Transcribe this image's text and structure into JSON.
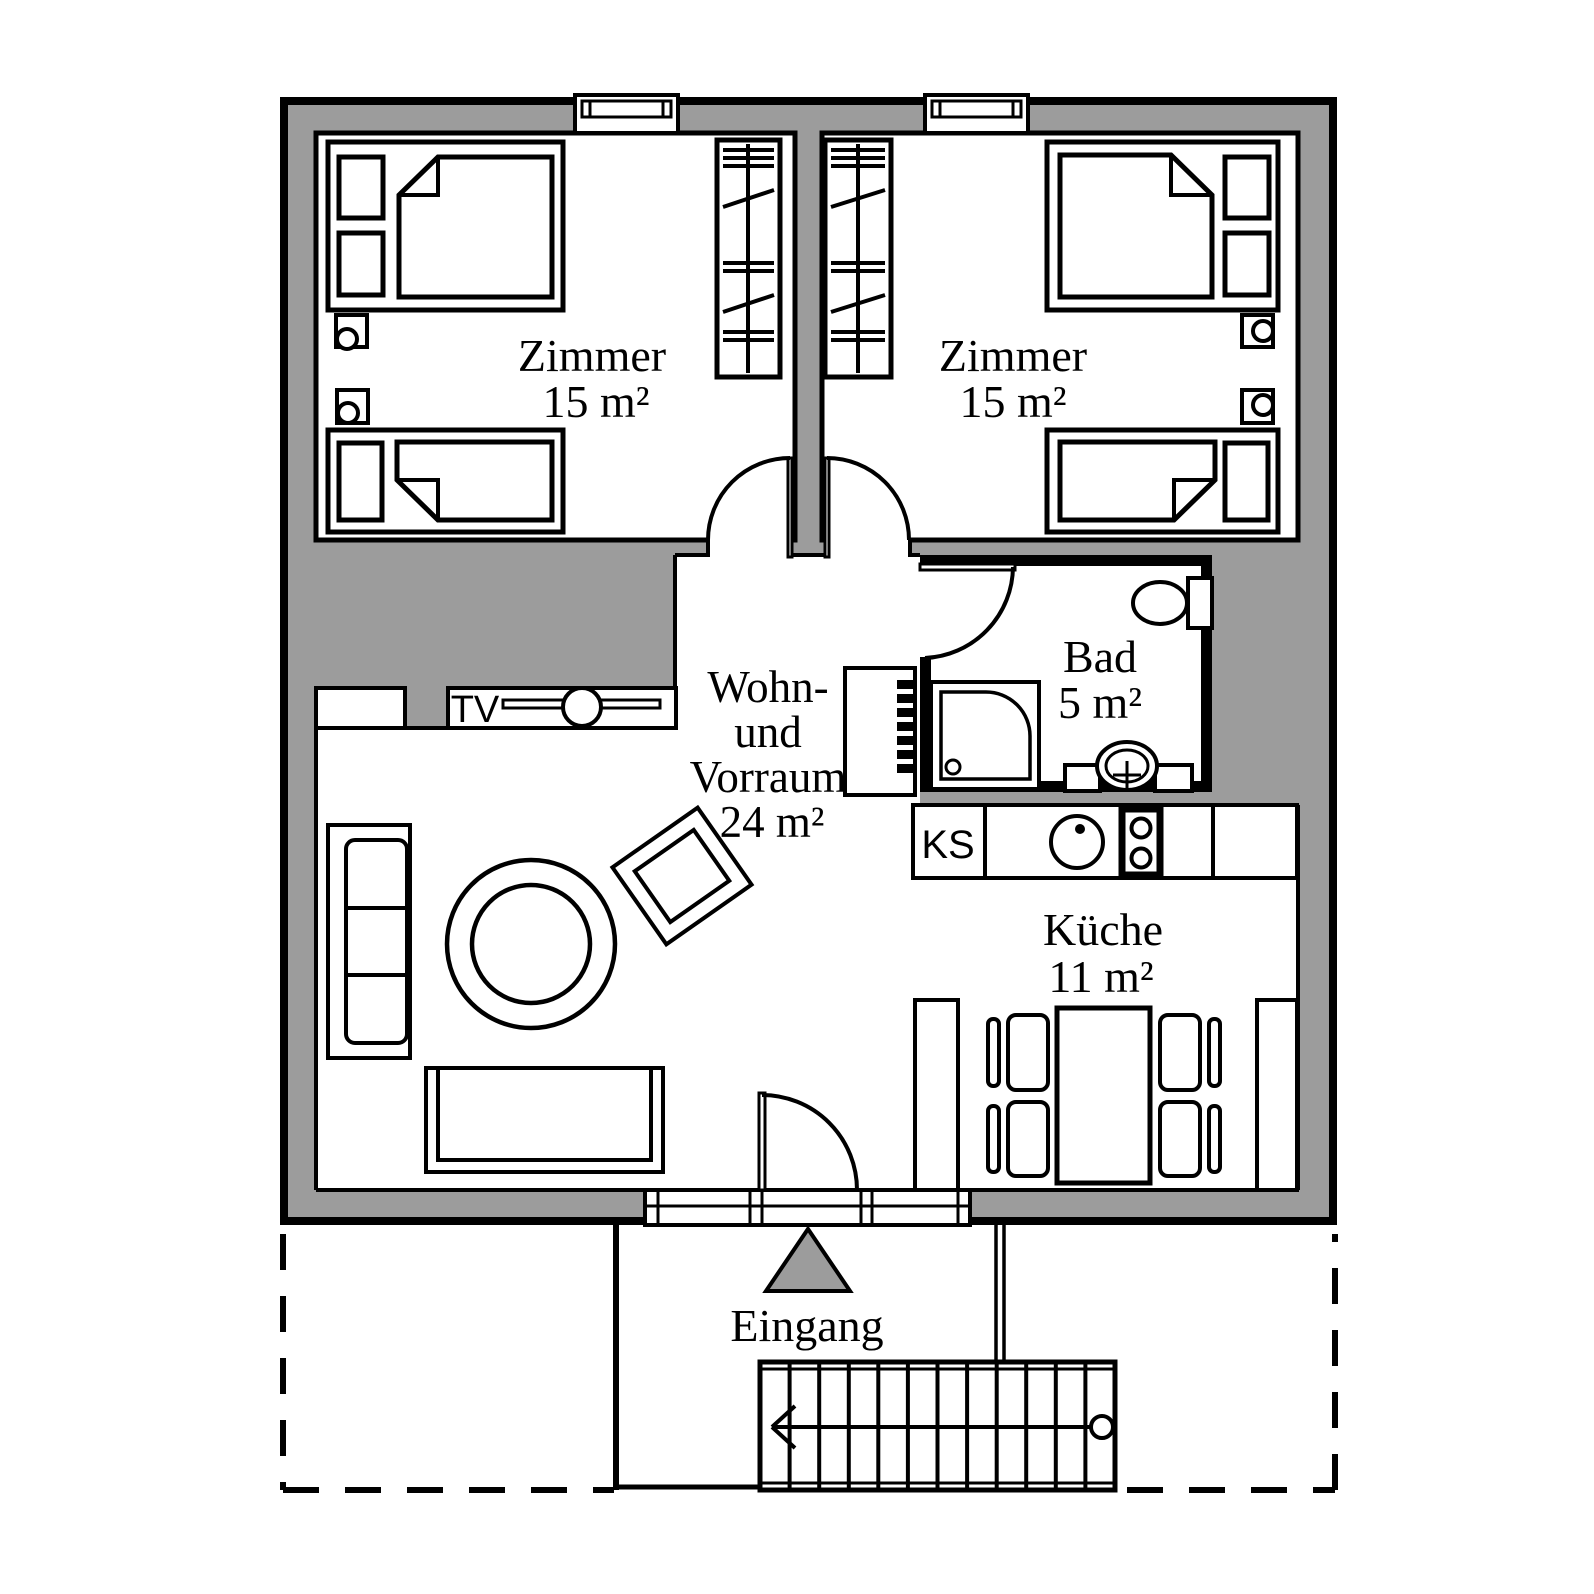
{
  "title": "Apartment floor plan",
  "colors": {
    "wall_fill": "#9c9c9c",
    "line": "#000000",
    "background": "#ffffff",
    "entrance_marker_fill": "#9c9c9c"
  },
  "rooms": {
    "bedroom_left": {
      "name": "Zimmer",
      "area": "15 m²"
    },
    "bedroom_right": {
      "name": "Zimmer",
      "area": "15 m²"
    },
    "bath": {
      "name": "Bad",
      "area": "5 m²"
    },
    "living": {
      "name_line1": "Wohn-",
      "name_line2": "und",
      "name_line3": "Vorraum",
      "area": "24 m²"
    },
    "kitchen": {
      "name": "Küche",
      "area": "11 m²"
    }
  },
  "labels": {
    "entrance": "Eingang",
    "fridge_abbr": "KS",
    "tv": "TV"
  }
}
